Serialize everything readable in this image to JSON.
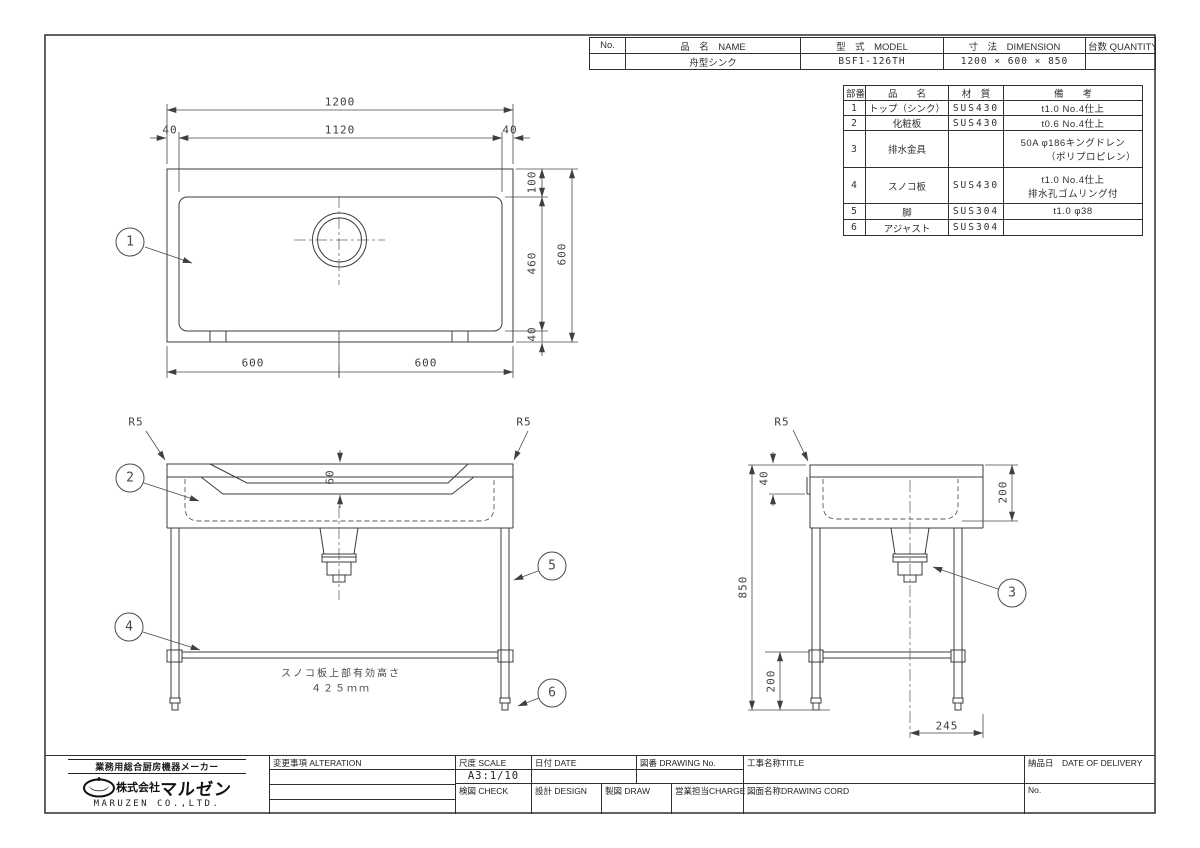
{
  "header_table": {
    "col_no": "No.",
    "col_name": "品　名　NAME",
    "col_model": "型　式　MODEL",
    "col_dimension": "寸　法　DIMENSION",
    "col_quantity": "台数 QUANTITY",
    "name": "舟型シンク",
    "model": "BSF1-126TH",
    "dimension": "1200 ×  600 ×  850",
    "no": "",
    "quantity": ""
  },
  "parts_table": {
    "col_part_no": "部番",
    "col_name": "品　　名",
    "col_material": "材　質",
    "col_note": "備　　考",
    "rows": [
      {
        "no": "1",
        "name": "トップ（シンク）",
        "material": "SUS430",
        "note1": "t1.0 No.4仕上",
        "note2": ""
      },
      {
        "no": "2",
        "name": "化粧板",
        "material": "SUS430",
        "note1": "t0.6 No.4仕上",
        "note2": ""
      },
      {
        "no": "3",
        "name": "排水金具",
        "material": "",
        "note1": "50A φ186キングドレン",
        "note2": "（ポリプロピレン）"
      },
      {
        "no": "4",
        "name": "スノコ板",
        "material": "SUS430",
        "note1": "t1.0 No.4仕上",
        "note2": "排水孔ゴムリング付"
      },
      {
        "no": "5",
        "name": "脚",
        "material": "SUS304",
        "note1": "t1.0 φ38",
        "note2": ""
      },
      {
        "no": "6",
        "name": "アジャスト",
        "material": "SUS304",
        "note1": "",
        "note2": ""
      }
    ]
  },
  "plan_view": {
    "balloon": "1",
    "dim_overall_width": "1200",
    "dim_inner_width": "1120",
    "dim_edge_left": "40",
    "dim_edge_right": "40",
    "dim_half_left": "600",
    "dim_half_right": "600",
    "dim_back": "100",
    "dim_bowl": "460",
    "dim_front": "40",
    "dim_depth": "600"
  },
  "front_view": {
    "balloon_panel": "2",
    "balloon_shelf": "4",
    "balloon_leg": "5",
    "balloon_adjuster": "6",
    "r5_left": "R5",
    "r5_right": "R5",
    "dim_rim": "60",
    "note_line1": "スノコ板上部有効高さ",
    "note_line2": "４２５ｍｍ"
  },
  "side_view": {
    "balloon_drain": "3",
    "r5": "R5",
    "dim_lip": "40",
    "dim_height": "850",
    "dim_bowl_depth": "200",
    "dim_shelf_height": "200",
    "dim_drain_offset": "245"
  },
  "title_block": {
    "maker_tagline": "業務用総合厨房機器メーカー",
    "company_prefix": "株式会社",
    "company_name": "マルゼン",
    "company_en": "MARUZEN CO.,LTD.",
    "alteration_label": "変更事項 ALTERATION",
    "scale_label": "尺度 SCALE",
    "scale_value": "A3:1/10",
    "date_label": "日付 DATE",
    "drawing_no_label": "図番 DRAWING No.",
    "title_label": "工事名称TITLE",
    "delivery_label": "納品日　DATE OF DELIVERY",
    "check_label": "検図 CHECK",
    "design_label": "設計 DESIGN",
    "draw_label": "製図 DRAW",
    "charge_label": "営業担当CHARGE",
    "drawing_cord_label": "図面名称DRAWING CORD",
    "no_label": "No."
  }
}
